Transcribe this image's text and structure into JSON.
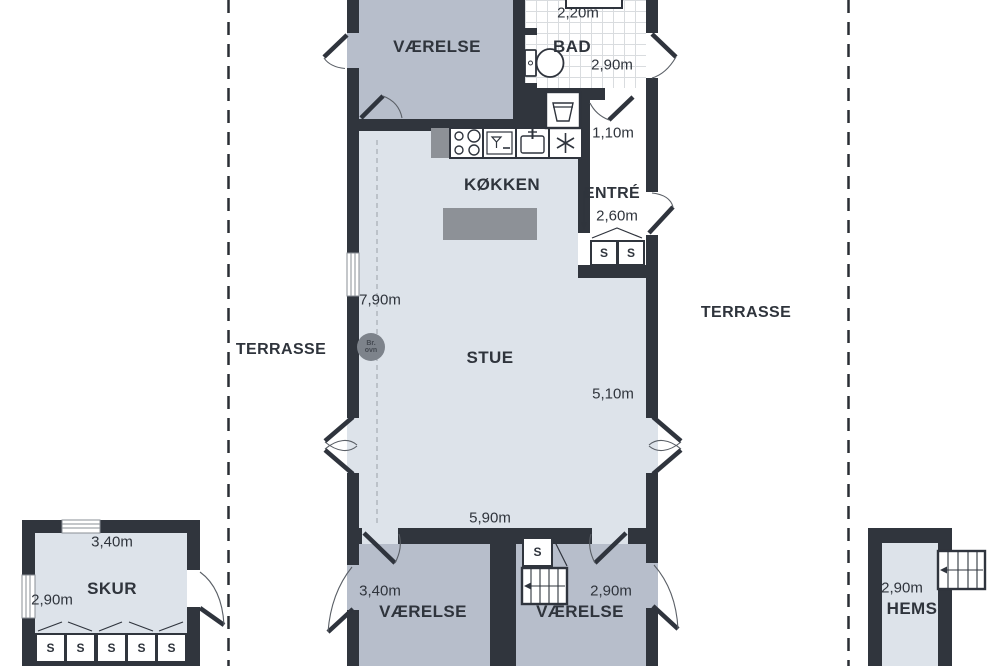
{
  "outdoor": {
    "terrasse_left": "TERRASSE",
    "terrasse_right": "TERRASSE"
  },
  "rooms": {
    "vaerelse_top": {
      "name": "VÆRELSE"
    },
    "bad": {
      "name": "BAD",
      "dim_top": "2,20m",
      "dim_right": "2,90m"
    },
    "hall": {
      "dim": "1,10m"
    },
    "entre": {
      "name": "ENTRÉ",
      "dim": "2,60m"
    },
    "koekken": {
      "name": "KØKKEN"
    },
    "stue": {
      "name": "STUE",
      "dim_left": "7,90m",
      "dim_right": "5,10m",
      "dim_bottom": "5,90m"
    },
    "vaerelse_left": {
      "name": "VÆRELSE",
      "dim": "3,40m"
    },
    "vaerelse_right": {
      "name": "VÆRELSE",
      "dim": "2,90m"
    },
    "skur": {
      "name": "SKUR",
      "dim_top": "3,40m",
      "dim_left": "2,90m"
    },
    "hems": {
      "name": "HEMS",
      "dim": "2,90m"
    }
  },
  "fixtures": {
    "wardrobe": "S",
    "wood_stove_line1": "Br.",
    "wood_stove_line2": "ovn"
  },
  "colors": {
    "wall": "#30353d",
    "room_gray": "#b7becb",
    "room_light": "#dde3ea",
    "counter": "#8d9197"
  }
}
